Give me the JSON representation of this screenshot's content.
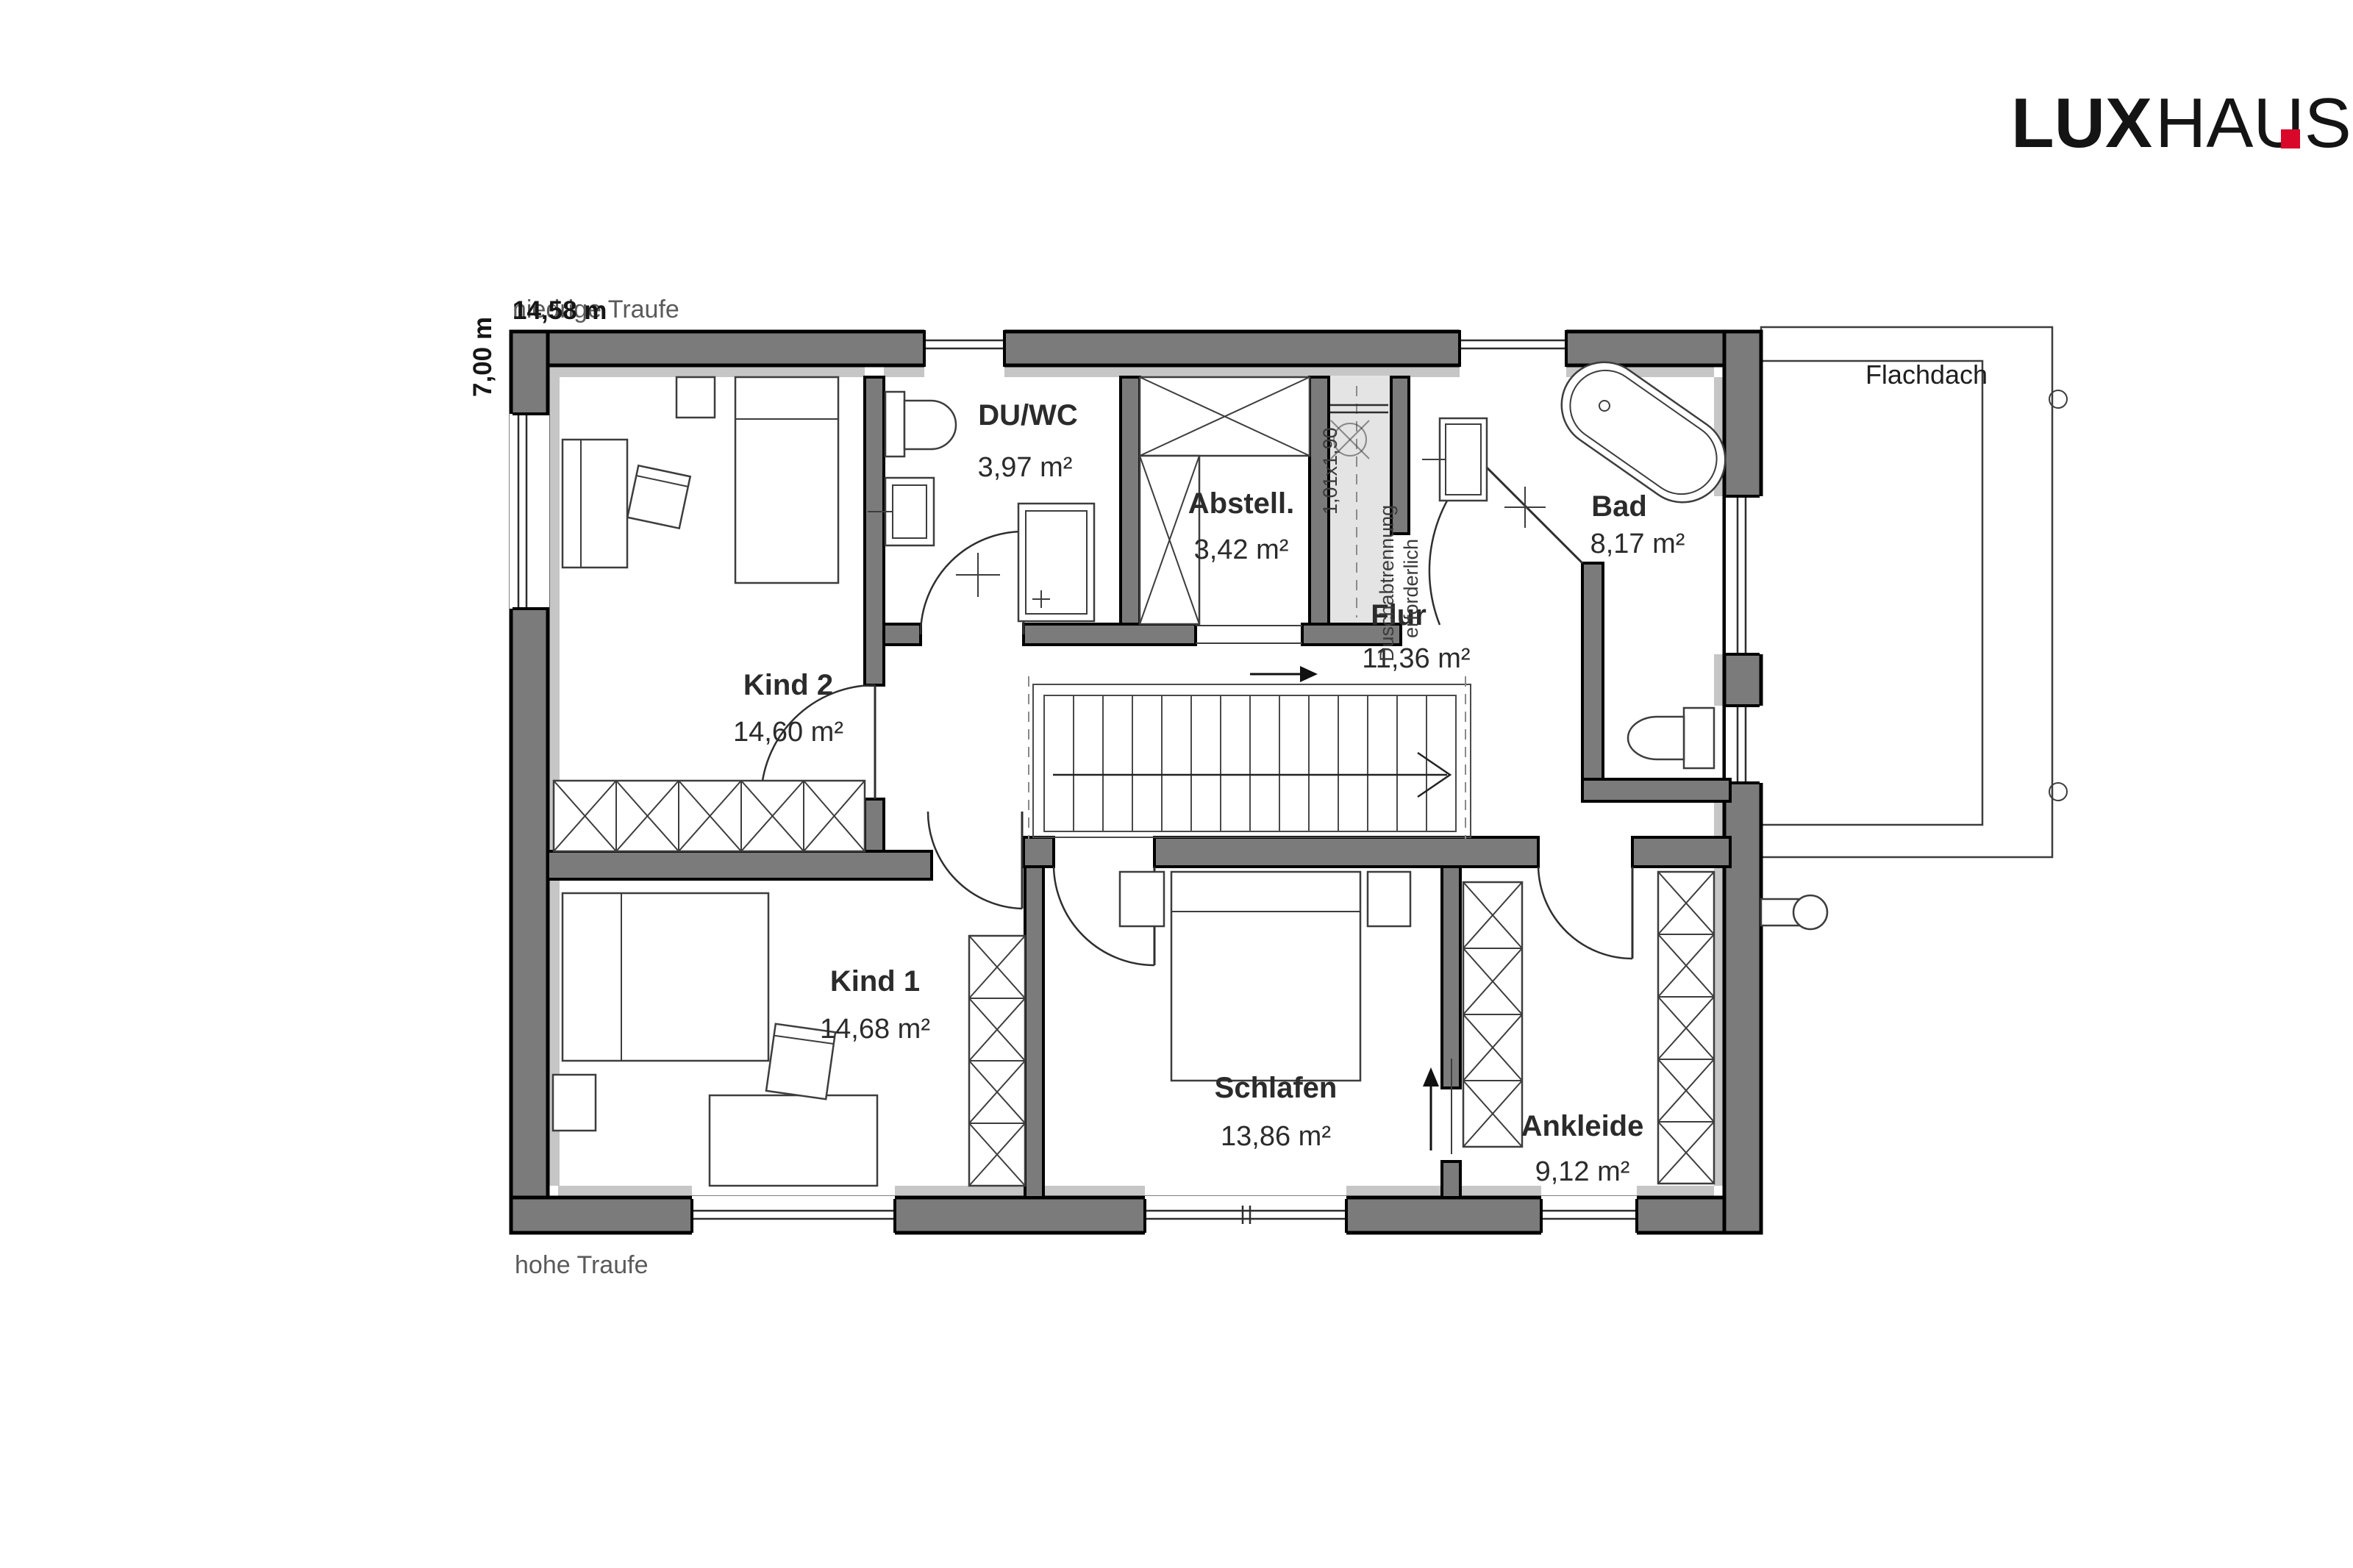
{
  "logo": {
    "bold": "LUX",
    "regular": "HAUS"
  },
  "dimensions": {
    "width_label": "14,58 m",
    "height_label": "7,00 m",
    "eaves_top": "niedrige Traufe",
    "eaves_bottom": "hohe Traufe"
  },
  "annotations": {
    "flat_roof": "Flachdach",
    "shower_size": "1,01x1,90",
    "shower_note_line1": "Duschabtrennung",
    "shower_note_line2": "erforderlich"
  },
  "rooms": {
    "kind2": {
      "name": "Kind 2",
      "area": "14,60 m²"
    },
    "duwc": {
      "name": "DU/WC",
      "area": "3,97 m²"
    },
    "abstell": {
      "name": "Abstell.",
      "area": "3,42 m²"
    },
    "flur": {
      "name": "Flur",
      "area": "11,36 m²"
    },
    "bad": {
      "name": "Bad",
      "area": "8,17 m²"
    },
    "kind1": {
      "name": "Kind 1",
      "area": "14,68 m²"
    },
    "schlafen": {
      "name": "Schlafen",
      "area": "13,86 m²"
    },
    "ankleide": {
      "name": "Ankleide",
      "area": "9,12 m²"
    }
  },
  "colors": {
    "wall": "#7b7b7b",
    "insulation_strip": "#c6c6c6",
    "shower_fill": "#e4e4e4",
    "logo_red": "#d9082a"
  }
}
